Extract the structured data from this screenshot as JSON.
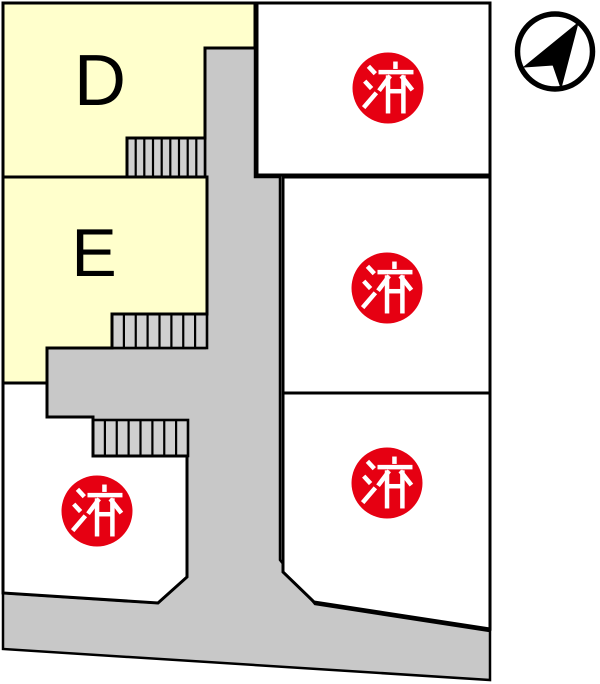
{
  "drawing": {
    "type": "land-lot-plan",
    "compass_icon": "north-arrow",
    "colors": {
      "available_lot": "#ffffcc",
      "sold_lot": "#ffffff",
      "road": "#c8c8c8",
      "stairs": "#d0d0d0",
      "outline": "#000000",
      "sold_badge": "#e60012",
      "sold_badge_text": "#ffffff",
      "lot_label_text": "#000000"
    },
    "lots": {
      "d": {
        "label": "D",
        "status": "available"
      },
      "e": {
        "label": "E",
        "status": "available"
      },
      "sold": [
        {
          "position": "top-right",
          "label": "済"
        },
        {
          "position": "middle-right",
          "label": "済"
        },
        {
          "position": "bottom-right",
          "label": "済"
        },
        {
          "position": "bottom-left",
          "label": "済"
        }
      ]
    }
  }
}
